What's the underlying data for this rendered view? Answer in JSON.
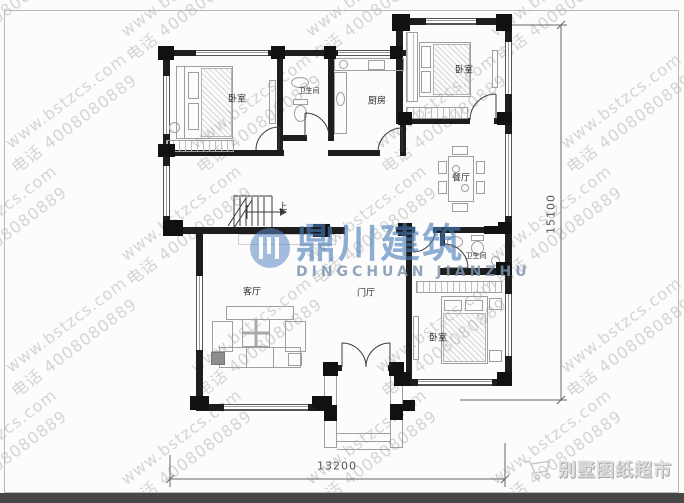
{
  "plan": {
    "rooms": [
      {
        "key": "bedroom-top-left",
        "label": "卧室"
      },
      {
        "key": "bathroom-top",
        "label": "卫生间"
      },
      {
        "key": "kitchen",
        "label": "厨房"
      },
      {
        "key": "bedroom-top-right",
        "label": "卧室"
      },
      {
        "key": "dining-room",
        "label": "餐厅"
      },
      {
        "key": "bathroom-right",
        "label": "卫生间"
      },
      {
        "key": "living-room",
        "label": "客厅"
      },
      {
        "key": "foyer",
        "label": "门厅"
      },
      {
        "key": "bedroom-bottom-right",
        "label": "卧室"
      }
    ],
    "stairs_up_label": "上",
    "dimensions": {
      "width_mm": "13200",
      "height_mm": "15100"
    }
  },
  "watermark": {
    "line1": "www.bstzcs.com",
    "line2": "电话 4008080889"
  },
  "logo": {
    "cn": "鼎川建筑",
    "en": "DINGCHUAN JIANZHU",
    "icon": "dingchuan-circle-logo"
  },
  "brand": {
    "text": "别墅图纸超市",
    "icon": "shopping-cart-icon"
  },
  "colors": {
    "wall": "#1d1d1d",
    "logo_blue": "#4a7cba",
    "watermark_gray": "#b5b5b5",
    "footer_bar": "#474747",
    "furniture_gray": "#9f9f9f"
  }
}
